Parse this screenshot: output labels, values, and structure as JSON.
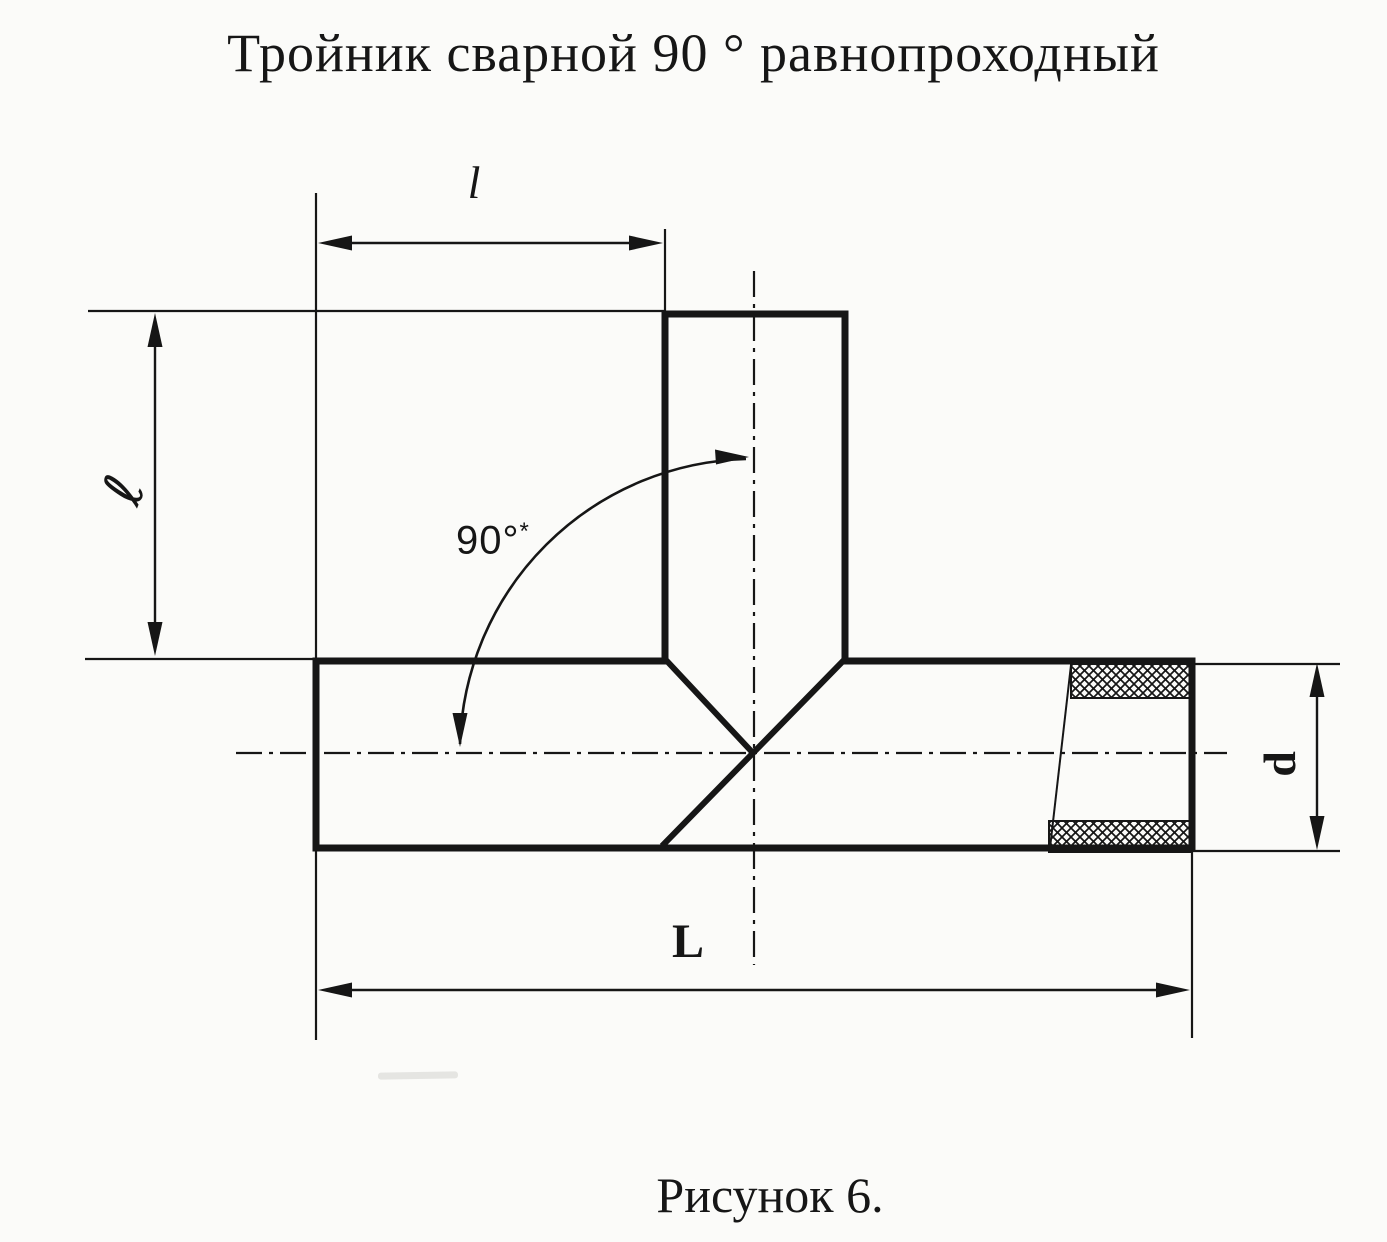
{
  "title": "Тройник сварной 90 ° равнопроходный",
  "caption": "Рисунок 6.",
  "drawing": {
    "type": "technical-diagram",
    "subject": "welded 90-degree equal-bore tee pipe fitting, front view with weld seam and wall section",
    "labels": {
      "branch_offset": "l",
      "branch_height": "ℓ",
      "angle_value": "90°",
      "angle_star": "*",
      "diameter": "d",
      "overall_length": "L"
    },
    "colors": {
      "ink": "#161616",
      "paper": "#fbfbf9"
    }
  }
}
